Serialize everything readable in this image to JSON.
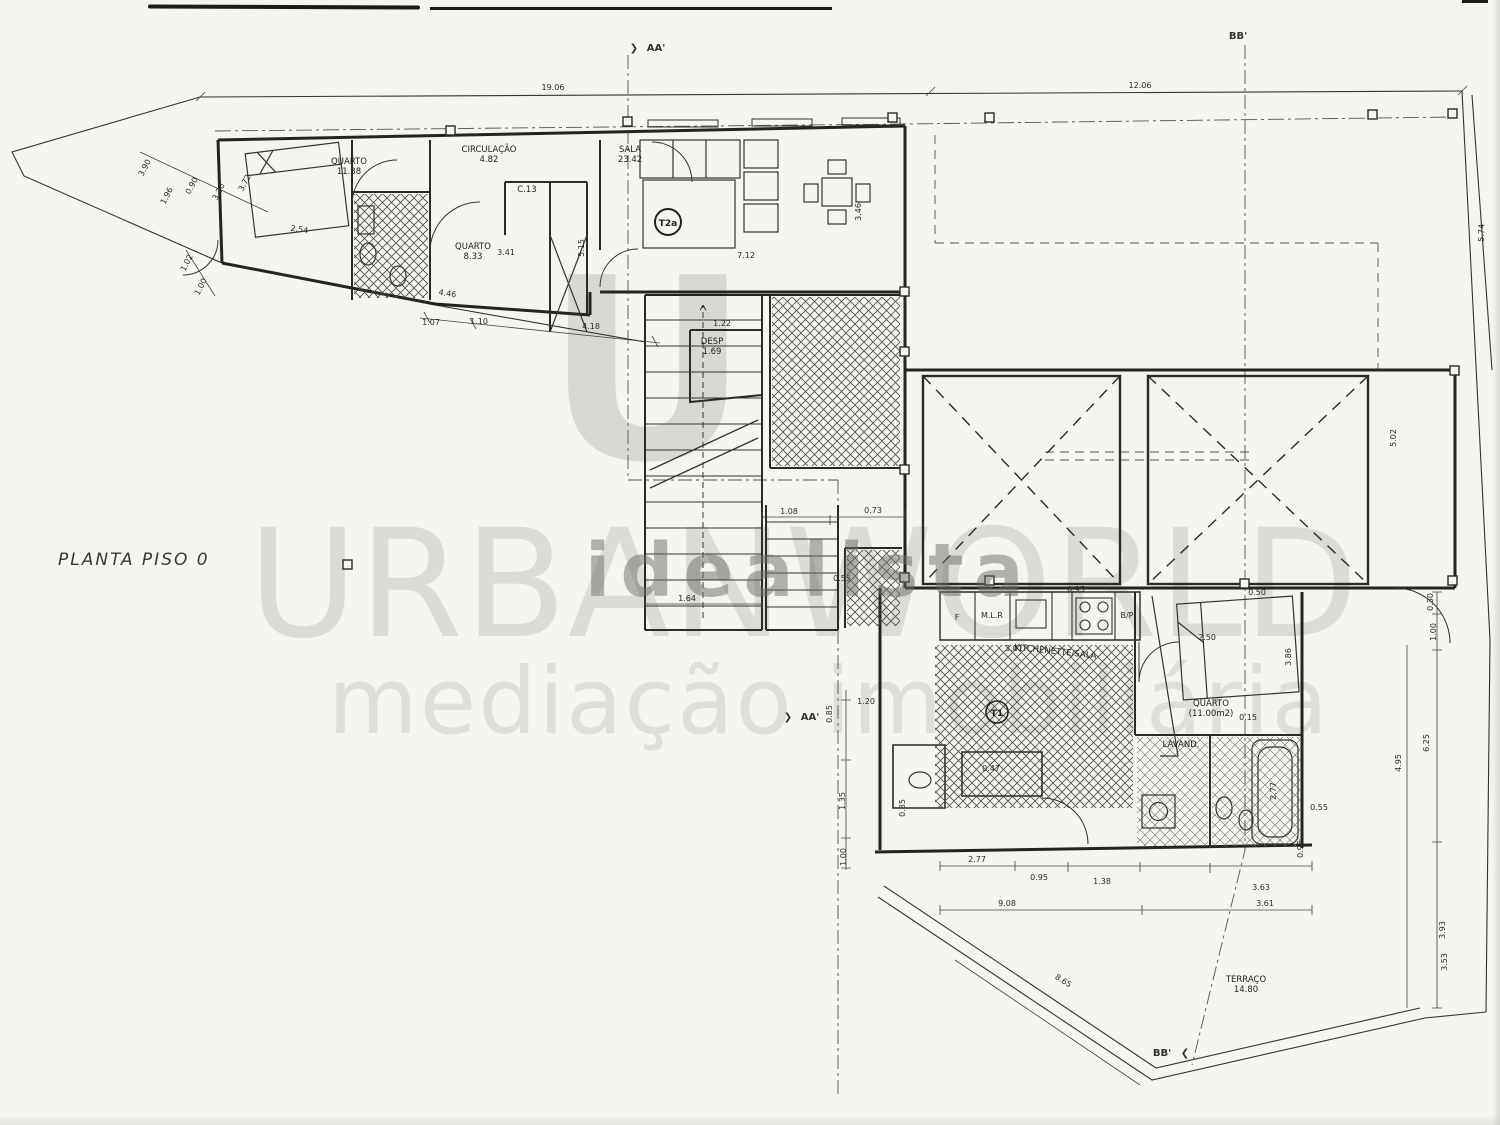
{
  "title": "PLANTA PISO 0",
  "watermarks": {
    "logo_letter": "U",
    "brand": "URBANWORLD",
    "tagline": "mediação imobiliária",
    "overlay": "idealista"
  },
  "icons": {
    "section_arrow_right": "❯",
    "section_arrow_left": "❮"
  },
  "section_markers": {
    "aa_top": "AA'",
    "aa_mid": "AA'",
    "bb_top": "BB'",
    "bb_bottom": "BB'"
  },
  "rooms": {
    "quarto1": {
      "name": "QUARTO",
      "area": "11.38"
    },
    "circulacao": {
      "name": "CIRCULAÇÃO",
      "area": "4.82"
    },
    "closet": {
      "name": "C.13"
    },
    "quarto2": {
      "name": "QUARTO",
      "area": "8.33"
    },
    "sala": {
      "name": "SALA",
      "area": "23.42"
    },
    "desp": {
      "name": "DESP",
      "area": "1.69"
    },
    "kitchenette": {
      "name": "KITCHENETTE/SALA"
    },
    "quarto3": {
      "name": "QUARTO",
      "area": "(11.00m2)"
    },
    "lavand": {
      "name": "LAVAND."
    },
    "terraco": {
      "name": "TERRAÇO",
      "area": "14.80"
    }
  },
  "unit_badges": {
    "t2": "T2a",
    "t1": "T1"
  },
  "appliances": {
    "fridge": "F",
    "washer": "M.L.R",
    "hob_dim": "3.01",
    "bp": "B/P"
  },
  "dims": [
    "19.06",
    "12.06",
    "5.74",
    "3.90",
    "1.96",
    "0.90",
    "3.20",
    "3.72",
    "2.54",
    "1.02",
    "1.00",
    "4.46",
    "1.07",
    "1.10",
    "4.18",
    "5.15",
    "3.41",
    "7.12",
    "3.46",
    "1.22",
    "1.08",
    "0.73",
    "0.55",
    "1.64",
    "1.20",
    "0.85",
    "1.35",
    "1.00",
    "0.85",
    "3.01",
    "0.47",
    "2.50",
    "0.15",
    "3.86",
    "2.77",
    "0.55",
    "0.95",
    "2.77",
    "0.95",
    "1.38",
    "3.63",
    "9.08",
    "3.61",
    "8.65",
    "0.30",
    "1.00",
    "6.25",
    "4.95",
    "3.93",
    "3.53",
    "5.02",
    "0.50",
    "0.95"
  ]
}
